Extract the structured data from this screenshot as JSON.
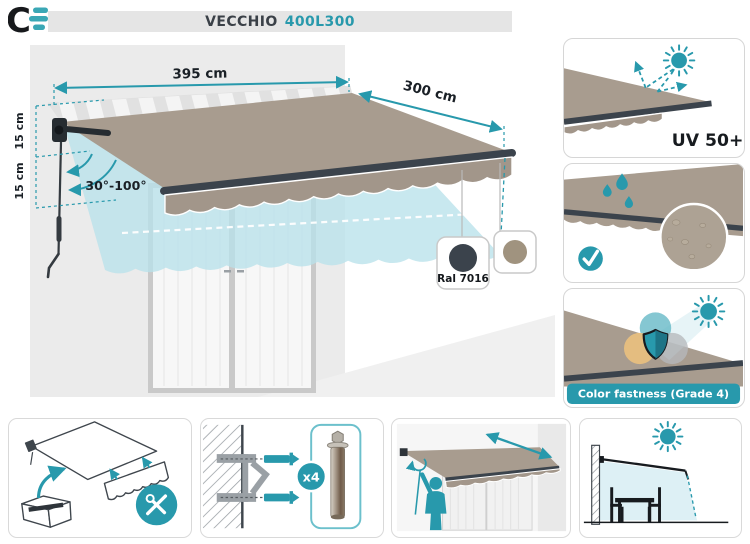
{
  "header": {
    "logo_letter": "C",
    "title": "VECCHIO",
    "model": "400L300"
  },
  "diagram": {
    "dimensions": {
      "width": "395 cm",
      "projection": "300 cm",
      "cassette_height": "15 cm",
      "drop": "15 cm",
      "tilt_range": "30°-100°"
    },
    "swatches": [
      {
        "label": "Ral 7016",
        "color": "#3b434c"
      },
      {
        "label": "",
        "color": "#a0937f"
      }
    ],
    "fabric_color": "#a89c8f",
    "accent_color": "#2899ac"
  },
  "features": {
    "uv": {
      "label": "UV 50+",
      "icons": [
        "sun-icon",
        "reflect-arrows-icon"
      ]
    },
    "water": {
      "icons": [
        "water-drops-icon",
        "check-icon",
        "magnifier-fabric-icon"
      ]
    },
    "fastness": {
      "label": "Color fastness (Grade 4)",
      "icons": [
        "sun-icon",
        "shield-icon",
        "color-circles-icon"
      ]
    }
  },
  "installation": {
    "anchor_count": "x4",
    "tools_icon": "wrench-screwdriver-icon",
    "step_icons": [
      "unbox-awning-icon",
      "wall-bracket-anchors-icon",
      "crank-operation-icon",
      "shade-coverage-icon"
    ]
  }
}
